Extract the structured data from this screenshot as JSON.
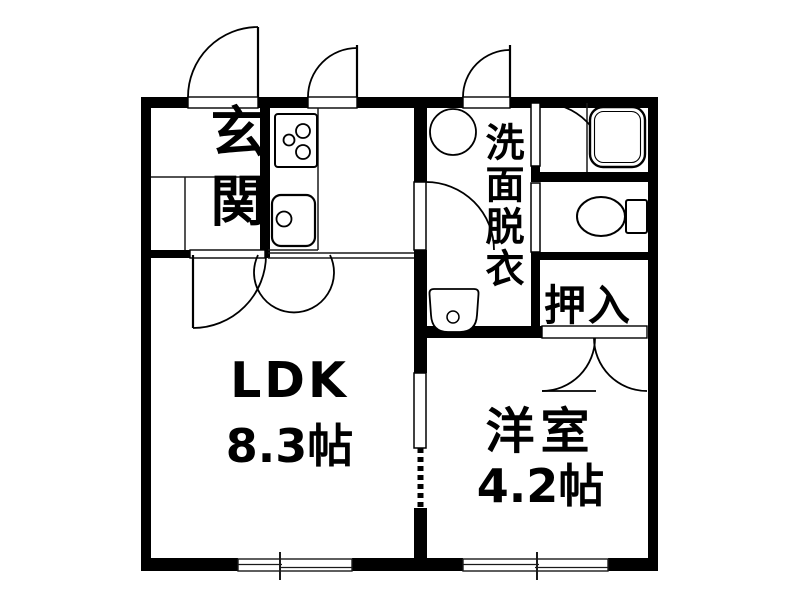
{
  "page": {
    "background": "#ffffff",
    "wall_color": "#000000",
    "line_color": "#000000"
  },
  "rooms": {
    "genkan": {
      "label": "玄関"
    },
    "ldk": {
      "label": "LDK",
      "size": "8.3帖"
    },
    "washroom": {
      "label": "洗面脱衣"
    },
    "oshiire": {
      "label": "押入"
    },
    "youshitsu": {
      "label": "洋室",
      "size": "4.2帖"
    }
  },
  "fixtures": [
    {
      "name": "stove-icon"
    },
    {
      "name": "sink-icon"
    },
    {
      "name": "washing-machine-icon"
    },
    {
      "name": "washbasin-icon"
    },
    {
      "name": "bathtub-icon"
    },
    {
      "name": "toilet-icon"
    }
  ]
}
